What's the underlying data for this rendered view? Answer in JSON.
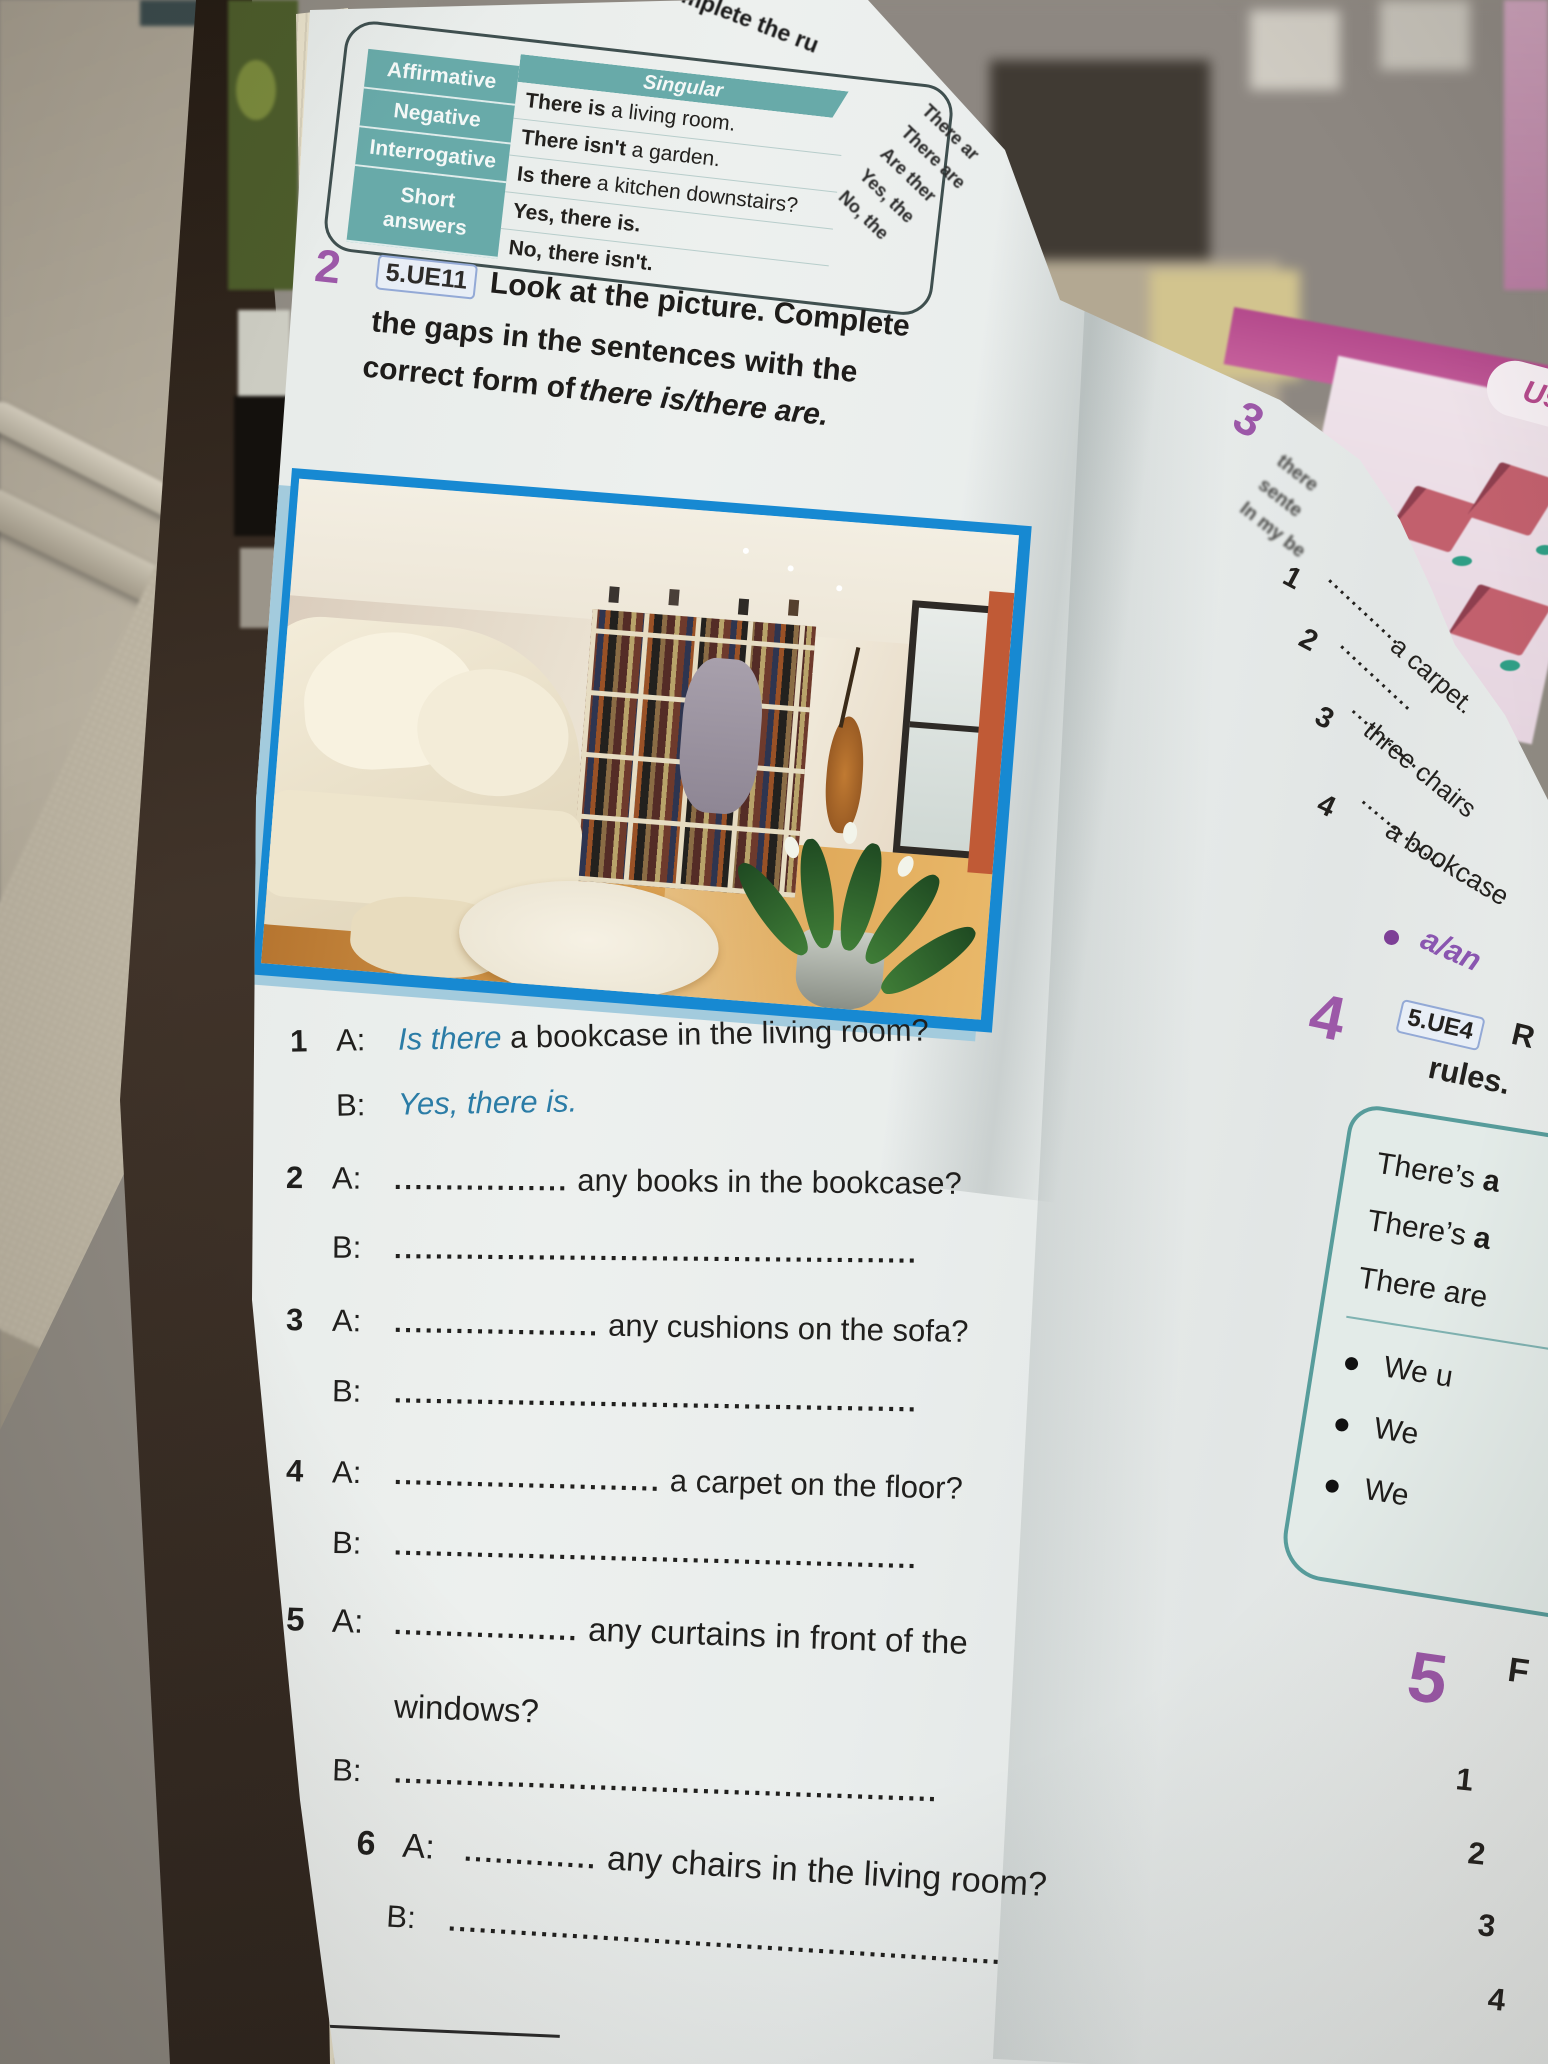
{
  "colors": {
    "exercise_number_purple": "#9c58a8",
    "table_teal": "#68aaa9",
    "answer_blue": "#2b7ca6",
    "picture_frame_blue": "#1789d2",
    "rules_box_teal": "#579c9b",
    "behind_page_magenta": "#b44a8c"
  },
  "curl_fragments": {
    "top": "complete the ru",
    "side": "rule"
  },
  "grammar_table": {
    "header": "Singular",
    "rows": [
      {
        "label": "Affirmative",
        "bold": "There is",
        "rest": " a living room."
      },
      {
        "label": "Negative",
        "bold": "There isn't",
        "rest": " a garden."
      },
      {
        "label": "Interrogative",
        "bold": "Is there",
        "rest": " a kitchen downstairs?"
      }
    ],
    "short_label_1": "Short",
    "short_label_2": "answers",
    "short_yes": "Yes, there is.",
    "short_no": "No, there isn't.",
    "plural_fragment_lines": [
      "There ar",
      "There are",
      "Are ther",
      "Yes, the",
      "No, the"
    ]
  },
  "exercise2": {
    "number": "2",
    "badge": "5.UE11",
    "line1": "Look at the picture. Complete",
    "line2": "the gaps in the sentences with the",
    "line3_bold": "correct form of",
    "line3_italic": "there is/there are.",
    "label_a": "A:",
    "label_b": "B:",
    "items": [
      {
        "n": "1",
        "a_answer": "Is there",
        "a_text": "a bookcase in the living room?",
        "b_answer": "Yes, there is."
      },
      {
        "n": "2",
        "a_dots": ".................",
        "a_text": "any books in the bookcase?",
        "b_dots": "..................................................."
      },
      {
        "n": "3",
        "a_dots": "....................",
        "a_text": "any cushions on the sofa?",
        "b_dots": "..................................................."
      },
      {
        "n": "4",
        "a_dots": "..........................",
        "a_text": "a carpet on the floor?",
        "b_dots": "..................................................."
      },
      {
        "n": "5",
        "a_dots": "..................",
        "a_text": "any curtains in front of the",
        "a_text2": "windows?",
        "b_dots": "....................................................."
      },
      {
        "n": "6",
        "a_dots": ".............",
        "a_text": "any chairs in the living room?",
        "b_dots": "......................................................"
      }
    ]
  },
  "footer": {
    "module": "MODULE 1"
  },
  "right_page": {
    "ex3": {
      "number": "3",
      "fragments": [
        "there",
        "sente",
        "In my be"
      ],
      "items": [
        {
          "n": "1",
          "dots": "............",
          "tail": ""
        },
        {
          "n": "2",
          "dots": "............",
          "tail": "a carpet."
        },
        {
          "n": "3",
          "dots": "............",
          "tail": "three chairs"
        },
        {
          "n": "4",
          "dots": ".............",
          "tail": "a bookcase"
        }
      ],
      "bullet": "a/an"
    },
    "ex4": {
      "number": "4",
      "badge": "5.UE4",
      "head": "R",
      "line2": "rules.",
      "box": {
        "l1_pre": "There’s ",
        "l1_b": "a",
        "l2_pre": "There’s ",
        "l2_b": "a",
        "l3": "There are",
        "bullets": [
          "We u",
          "We",
          "We"
        ]
      }
    },
    "ex5": {
      "number": "5",
      "head": "F",
      "items": [
        "1",
        "2",
        "3",
        "4"
      ]
    }
  },
  "behind_page": {
    "us": "Us"
  }
}
